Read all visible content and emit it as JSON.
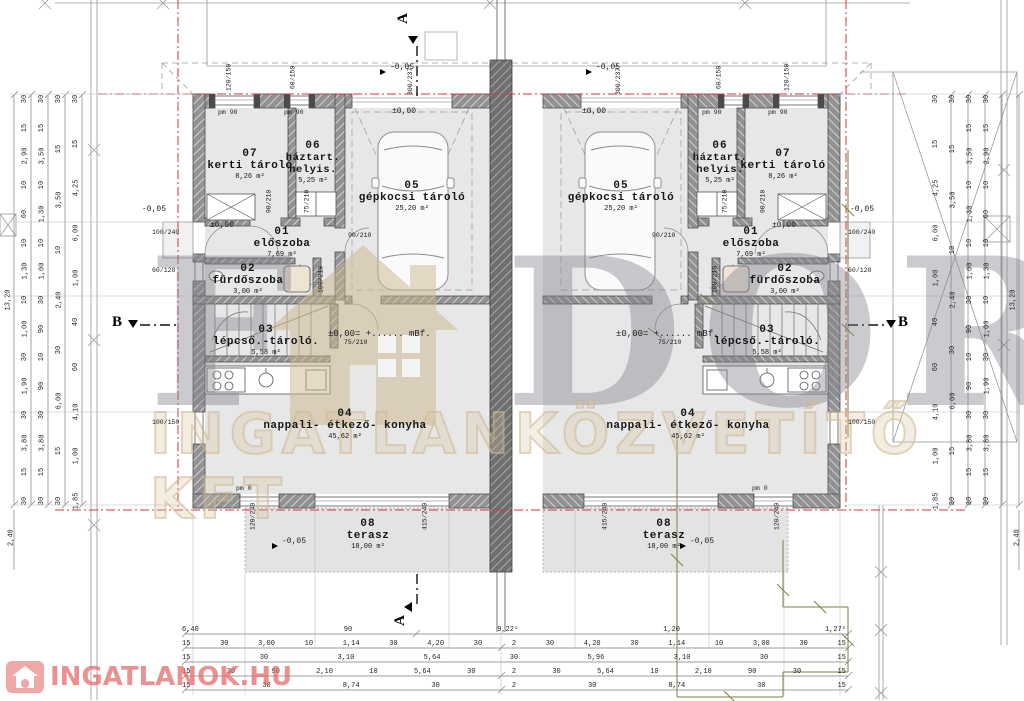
{
  "watermark": {
    "letter_f": "F",
    "letters_dor": "DOR",
    "line2": "INGATLANKÖZVETÍTŐ KFT"
  },
  "logo_text": "INGATLANOK.HU",
  "sections": {
    "a": "A",
    "b": "B"
  },
  "levels": {
    "zero": "±0,00",
    "minus5": "-0,05",
    "mbf_note": "±0,00= +...... mBf."
  },
  "rooms": {
    "storage_garden": {
      "num": "07",
      "name": "kerti tároló",
      "area": "8,26 m²"
    },
    "utility": {
      "num": "06",
      "name": "háztart. helyis.",
      "area": "5,25 m²"
    },
    "garage": {
      "num": "05",
      "name": "gépkocsi tároló",
      "area": "25,20 m²"
    },
    "hall": {
      "num": "01",
      "name": "előszoba",
      "area": "7,69 m²"
    },
    "bathroom": {
      "num": "02",
      "name": "fürdőszoba",
      "area": "3,00 m²"
    },
    "stairs": {
      "num": "03",
      "name": "lépcső.-tároló.",
      "area": "5,58 m²"
    },
    "living": {
      "num": "04",
      "name": "nappali- étkező- konyha",
      "area": "45,62 m²"
    },
    "terrace": {
      "num": "08",
      "name": "terasz",
      "area": "18,00 m²"
    }
  },
  "openings": {
    "pm90": "pm 90",
    "pm0": "pm 0",
    "w120_150": "120/150",
    "w60_150": "60/150",
    "w100_240": "100/240",
    "w60_120": "60/120",
    "w100_150": "100/150",
    "d90_210": "90/210",
    "d75_210": "75/210",
    "d100_210": "100/210",
    "d120_240": "120/240",
    "d415_240": "415/240",
    "g300_237": "300/237⁵"
  },
  "dims": {
    "bottom_row1": [
      "6,40",
      "90",
      "9,22¹",
      "1,20",
      "1,27⁵"
    ],
    "bottom_row2": [
      "15",
      "30",
      "3,00",
      "10",
      "1,14",
      "30",
      "4,20",
      "30",
      "2",
      "30",
      "4,20",
      "30",
      "1,14",
      "10",
      "3,00",
      "30",
      "15"
    ],
    "bottom_row3": [
      "15",
      "30",
      "3,10",
      "5,64",
      "30",
      "5,96",
      "3,10",
      "30",
      "15"
    ],
    "bottom_row4": [
      "15",
      "30",
      "90",
      "2,10",
      "10",
      "5,64",
      "30",
      "2",
      "30",
      "5,64",
      "10",
      "2,10",
      "90",
      "30",
      "15"
    ],
    "bottom_row5": [
      "15",
      "30",
      "8,74",
      "30",
      "2",
      "30",
      "8,74",
      "30",
      "15"
    ],
    "left_col1": [
      "13,20"
    ],
    "left_col2": [
      "30",
      "15",
      "2,90",
      "10",
      "60",
      "10",
      "1,30",
      "10",
      "1,00",
      "30",
      "1,90",
      "30",
      "3,80",
      "15",
      "30"
    ],
    "left_col3": [
      "30",
      "15",
      "3,50",
      "10",
      "1,30",
      "10",
      "1,00",
      "30",
      "90",
      "10",
      "90",
      "30",
      "3,80",
      "15",
      "30"
    ],
    "left_col4": [
      "30",
      "15",
      "3,50",
      "10",
      "2,40",
      "30",
      "6,00",
      "15",
      "30"
    ],
    "left_col5": [
      "30",
      "15",
      "4,25",
      "6,00",
      "1,00",
      "40",
      "60",
      "4,10",
      "1,00",
      "1,85"
    ],
    "right_col1": [
      "13,20"
    ],
    "right_col2": [
      "30",
      "15",
      "2,90",
      "10",
      "60",
      "10",
      "1,30",
      "10",
      "1,00",
      "30",
      "1,90",
      "30",
      "3,80",
      "15",
      "30"
    ],
    "right_col3": [
      "30",
      "15",
      "3,50",
      "10",
      "1,30",
      "10",
      "1,00",
      "30",
      "90",
      "10",
      "90",
      "30",
      "3,80",
      "15",
      "30"
    ],
    "right_col4": [
      "30",
      "15",
      "3,50",
      "10",
      "2,40",
      "30",
      "6,00",
      "15",
      "30"
    ],
    "right_col5": [
      "30",
      "15",
      "4,25",
      "6,00",
      "1,00",
      "40",
      "60",
      "4,10",
      "1,00",
      "1,85"
    ],
    "corner_left_bottom": "2,40",
    "corner_right_bottom": "2,40"
  }
}
